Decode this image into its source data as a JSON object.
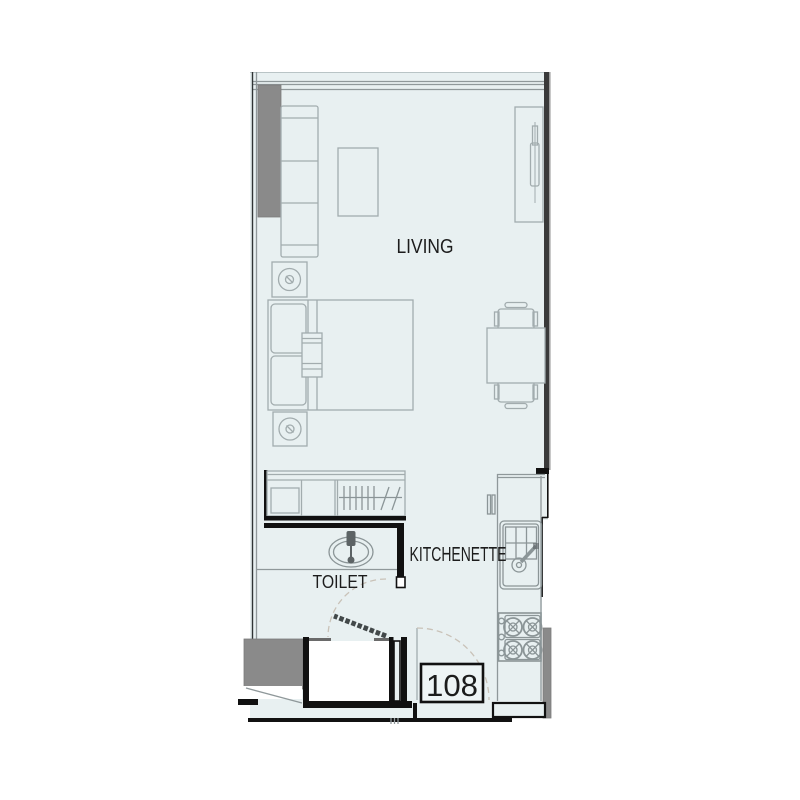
{
  "title": "Unit floor plan",
  "unit": {
    "number": "108"
  },
  "rooms": {
    "living": {
      "label": "LIVING"
    },
    "toilet": {
      "label": "TOILET"
    },
    "kitchenette": {
      "label": "KITCHENETTE"
    }
  },
  "colors": {
    "floor_fill": "#e8f0f1",
    "wall_color": "#111111",
    "column_color": "#8a8a8a",
    "line_color": "#a2acae",
    "door_arc_color": "#c9c2b8",
    "text_color": "#1c1c1c",
    "bg": "#ffffff"
  }
}
